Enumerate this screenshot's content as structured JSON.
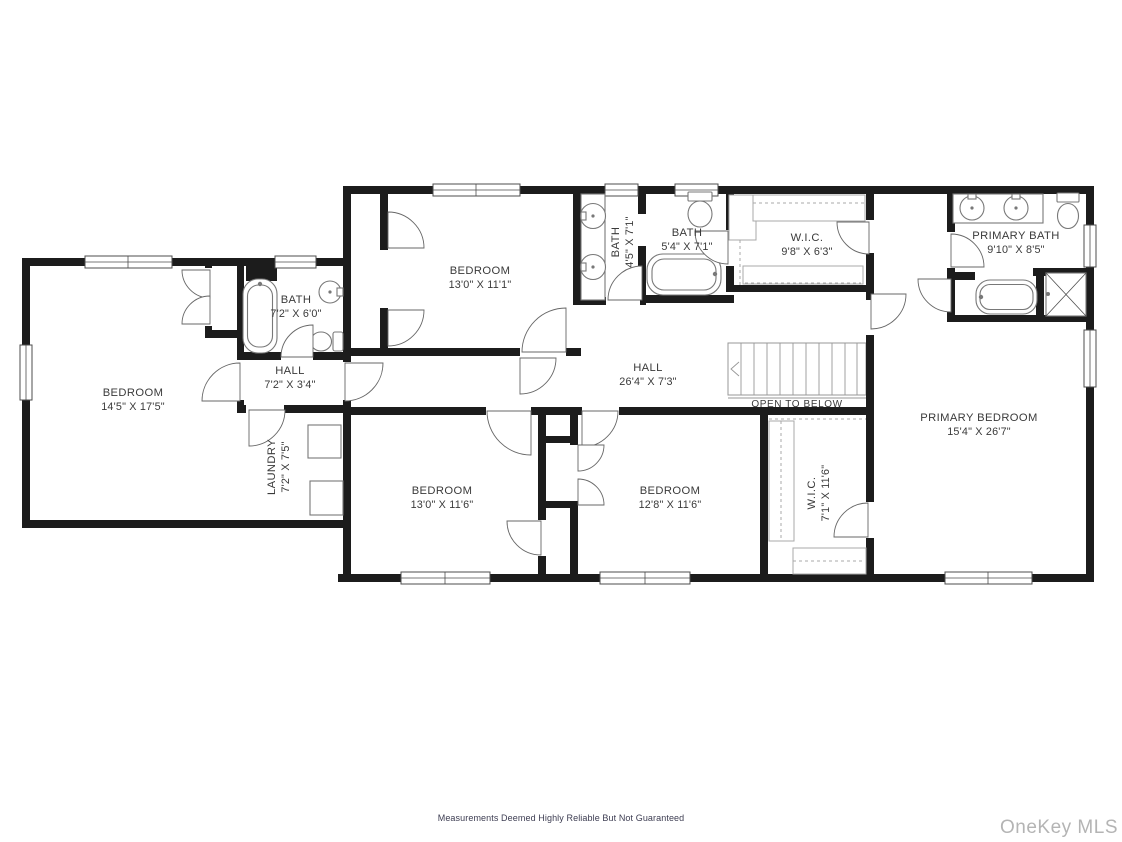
{
  "rooms": [
    {
      "id": "bedroom-left",
      "name": "BEDROOM",
      "dims": "14'5\" X 17'5\""
    },
    {
      "id": "bath-left",
      "name": "BATH",
      "dims": "7'2\" X 6'0\""
    },
    {
      "id": "hall-left",
      "name": "HALL",
      "dims": "7'2\" X 3'4\""
    },
    {
      "id": "laundry",
      "name": "LAUNDRY",
      "dims": "7'2\" X 7'5\""
    },
    {
      "id": "bedroom-top",
      "name": "BEDROOM",
      "dims": "13'0\" X 11'1\""
    },
    {
      "id": "bath-middle",
      "name": "BATH",
      "dims": "4'5\" X 7'1\""
    },
    {
      "id": "bath-hall",
      "name": "BATH",
      "dims": "5'4\" X 7'1\""
    },
    {
      "id": "wic-top",
      "name": "W.I.C.",
      "dims": "9'8\" X 6'3\""
    },
    {
      "id": "primary-bath",
      "name": "PRIMARY BATH",
      "dims": "9'10\" X 8'5\""
    },
    {
      "id": "hall-main",
      "name": "HALL",
      "dims": "26'4\" X 7'3\""
    },
    {
      "id": "primary-bedroom",
      "name": "PRIMARY BEDROOM",
      "dims": "15'4\" X 26'7\""
    },
    {
      "id": "bedroom-bottom-left",
      "name": "BEDROOM",
      "dims": "13'0\" X 11'6\""
    },
    {
      "id": "bedroom-bottom-middle",
      "name": "BEDROOM",
      "dims": "12'8\" X 11'6\""
    },
    {
      "id": "wic-bottom",
      "name": "W.I.C.",
      "dims": "7'1\" X 11'6\""
    }
  ],
  "annotations": {
    "open_to_below": "OPEN TO BELOW"
  },
  "footer": {
    "disclaimer": "Measurements Deemed Highly Reliable But Not Guaranteed",
    "watermark": "OneKey MLS"
  },
  "colors": {
    "wall": "#1c1c1c",
    "line": "#676767",
    "label": "#3a3a3a",
    "watermark": "#b4b4b4"
  }
}
